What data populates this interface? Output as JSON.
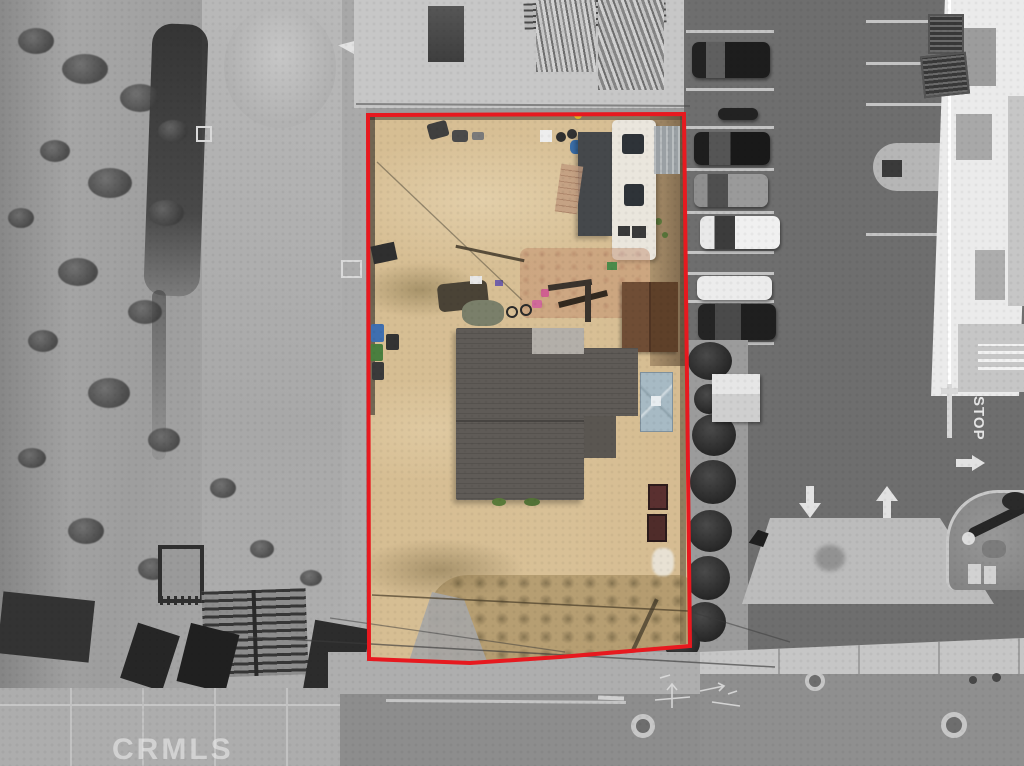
{
  "scene": {
    "kind": "aerial-drone-photograph",
    "description": "Top-down drone photo of a dirt parcel outlined in red; the parcel is shown in color with a gray-roof house, white travel trailer with carport awning, brown shed, blue canopy and scattered yard items; surrounding desert lots, a commercial parking lot with parked cars, a building with rooftop AC units, and streets are desaturated grayscale.",
    "width_px": 1024,
    "height_px": 766
  },
  "watermark": {
    "text": "CRMLS"
  },
  "boundary": {
    "color": "#e7191f",
    "stroke_width_px": 4,
    "points": "368,115 684,114 690,646 560,657 470,663 369,659"
  },
  "parcel": {
    "ground_color": "#d5bb90",
    "house_roof_color": "#5f5b57",
    "trailer_color": "#eae6dd",
    "awning_color": "#45484b",
    "shed_color": "#6b4a33",
    "canopy_color": "#a7bac4",
    "bin_colors": [
      "#3f6fb0",
      "#4a7f3f",
      "#3a3a3a"
    ],
    "features": [
      "main house with dark gray shingle roof",
      "white travel trailer with dark carport awning",
      "brown gable shed",
      "light blue canopy",
      "yard items: bicycles, tarps, boards, barrels, chairs",
      "trash bins along west fence",
      "dry brush along south edge",
      "bare sand ground"
    ]
  },
  "surroundings": {
    "rendering": "grayscale",
    "west": "vacant desert scrub with graded dirt, debris piles and pallet racks",
    "north": "construction pad with stacked lumber and pipes",
    "east": "parking lot with parked vehicles and a commercial building with rooftop AC units",
    "south": "street with curbs, lane line, manhole covers and white utility survey markings"
  },
  "east_lot": {
    "vehicles": [
      "dark pickup truck",
      "motorcycle",
      "dark sedan",
      "gray sedan",
      "white sedan",
      "white van",
      "dark SUV",
      "white truck",
      "dark SUV"
    ],
    "pavement_marking_text": "STOP",
    "lane_arrows": [
      "down",
      "up",
      "right"
    ],
    "landscape": "row of round shrubs and a small white shed along the west edge; round gravel planter with palm tree at the south-east"
  },
  "street": {
    "manhole_covers": 3,
    "utility_marking_color": "#dcdcdc"
  }
}
